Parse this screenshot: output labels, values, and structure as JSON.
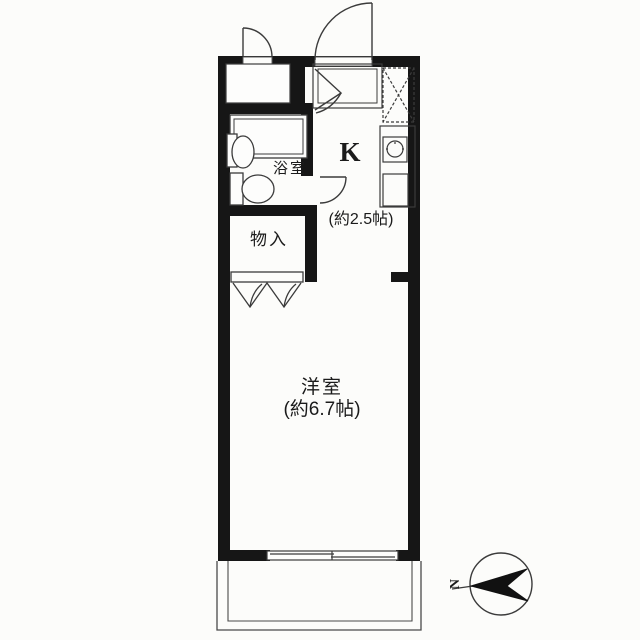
{
  "plan": {
    "rooms": {
      "bathroom": {
        "label": "浴室"
      },
      "kitchen": {
        "label": "K",
        "size": "(約2.5帖)"
      },
      "storage": {
        "label": "物入"
      },
      "western_room": {
        "label": "洋室",
        "size": "(約6.7帖)"
      }
    },
    "compass": {
      "north_label": "N"
    },
    "colors": {
      "wall": "#161616",
      "line": "#3b3b3b",
      "background": "#fcfcfa",
      "text": "#1b1b1b"
    }
  }
}
